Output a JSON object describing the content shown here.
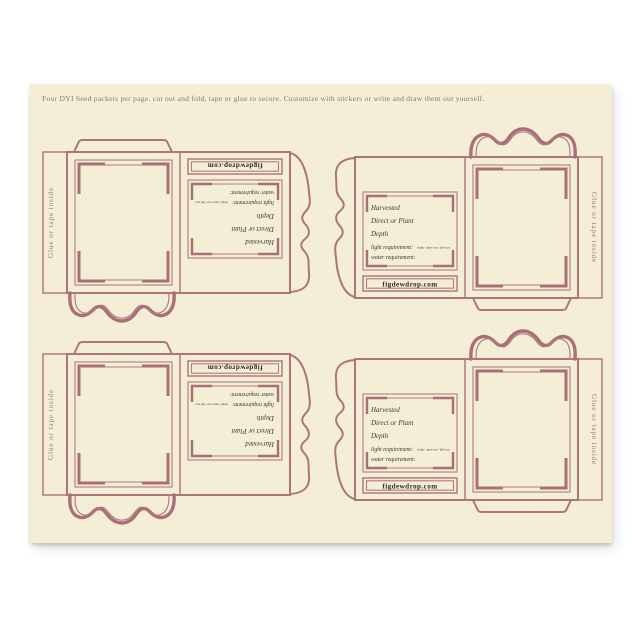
{
  "header": {
    "instructions": "Four DYI Seed packets per page. cut out and fold, tape or glue to secure. Customize with stickers or write and draw them out yourself."
  },
  "packet": {
    "glue_flap_label": "Glue or tape inside",
    "fields": {
      "harvested": "Harvested",
      "direct_or_plant": "Direct or Plant",
      "depth": "Depth",
      "light_requirement": "light requirement:",
      "light_options": "shade / part sun / full sun",
      "water_requirement": "water requirement:"
    },
    "website": "figdewdrop.com"
  },
  "colors": {
    "background": "#ffffff",
    "page": "#f5eed6",
    "outline": "#b07a80",
    "outline_dark": "#a96f76",
    "header_text": "#8a7b55",
    "flap_text": "#98836f",
    "script_text": "#40332b",
    "website_text": "#332a22"
  }
}
